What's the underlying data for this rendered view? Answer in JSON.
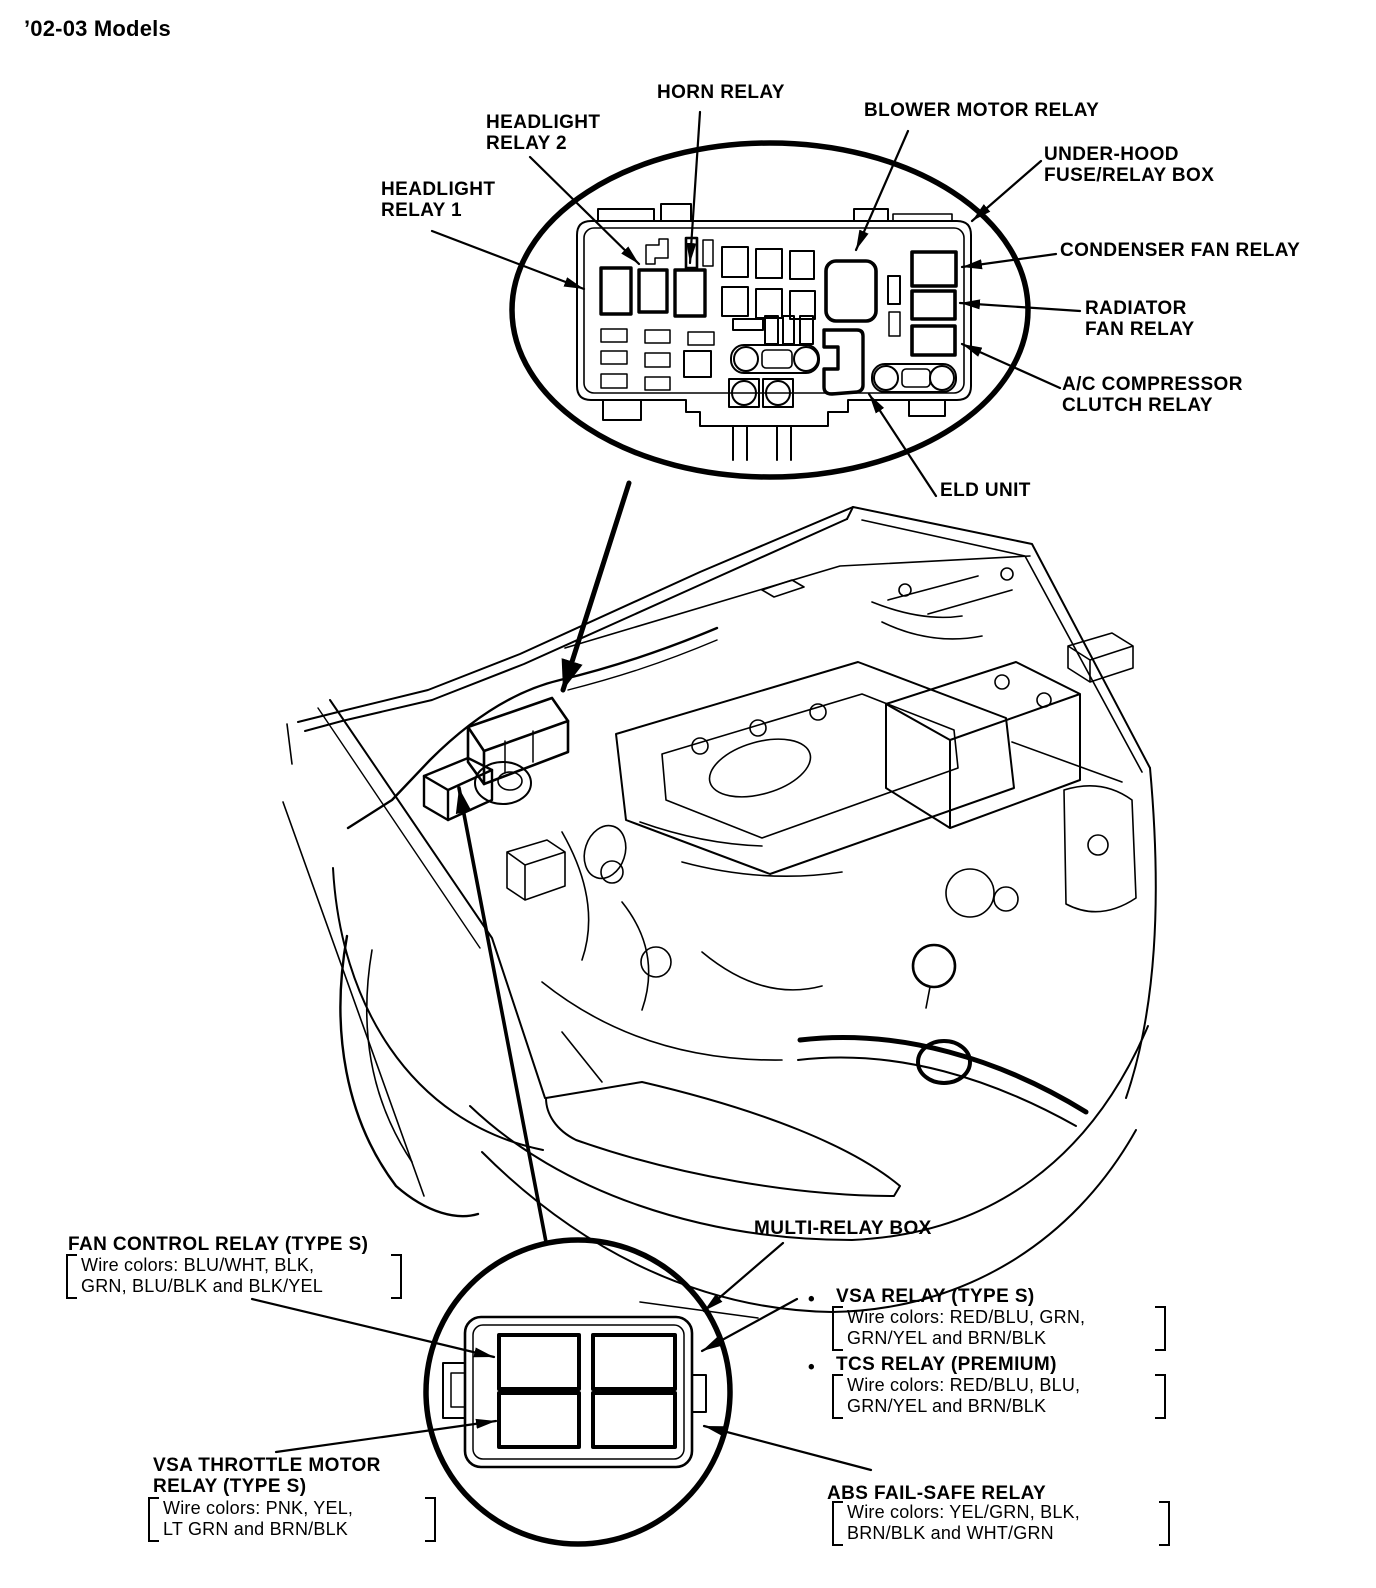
{
  "title": "’02-03 Models",
  "colors": {
    "ink": "#000000",
    "paper": "#ffffff"
  },
  "under_hood_callout": {
    "horn_relay": "HORN RELAY",
    "headlight_relay_2_line1": "HEADLIGHT",
    "headlight_relay_2_line2": "RELAY 2",
    "headlight_relay_1_line1": "HEADLIGHT",
    "headlight_relay_1_line2": "RELAY 1",
    "blower_motor_relay": "BLOWER MOTOR RELAY",
    "box_name_line1": "UNDER-HOOD",
    "box_name_line2": "FUSE/RELAY BOX",
    "condenser_fan_relay": "CONDENSER FAN RELAY",
    "radiator_fan_relay_line1": "RADIATOR",
    "radiator_fan_relay_line2": "FAN RELAY",
    "ac_compressor_line1": "A/C COMPRESSOR",
    "ac_compressor_line2": "CLUTCH RELAY",
    "eld_unit": "ELD UNIT"
  },
  "multi_relay_callout": {
    "box_name": "MULTI-RELAY BOX",
    "fan_control": {
      "name": "FAN CONTROL RELAY (TYPE S)",
      "wire1": "Wire colors: BLU/WHT, BLK,",
      "wire2": "GRN, BLU/BLK and BLK/YEL"
    },
    "vsa_relay": {
      "bullet": "•",
      "name": "VSA RELAY (TYPE S)",
      "wire1": "Wire colors: RED/BLU, GRN,",
      "wire2": "GRN/YEL and BRN/BLK"
    },
    "tcs_relay": {
      "bullet": "•",
      "name": "TCS RELAY (PREMIUM)",
      "wire1": "Wire colors: RED/BLU, BLU,",
      "wire2": "GRN/YEL and BRN/BLK"
    },
    "vsa_throttle": {
      "name_line1": "VSA THROTTLE MOTOR",
      "name_line2": "RELAY (TYPE S)",
      "wire1": "Wire colors: PNK, YEL,",
      "wire2": "LT GRN and BRN/BLK"
    },
    "abs_fail_safe": {
      "name": "ABS FAIL-SAFE RELAY",
      "wire1": "Wire colors: YEL/GRN, BLK,",
      "wire2": "BRN/BLK and WHT/GRN"
    }
  }
}
